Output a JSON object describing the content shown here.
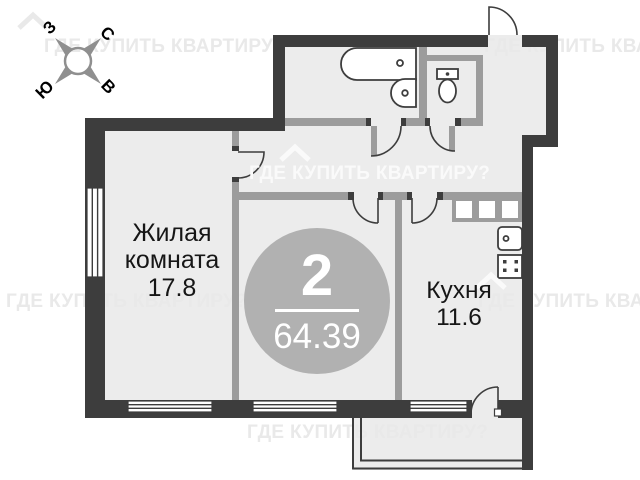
{
  "title": "Floor plan — 2-room apartment",
  "watermark": {
    "text": "ГДЕ КУПИТЬ КВАРТИРУ?"
  },
  "compass": {
    "north": "С",
    "south": "Ю",
    "west": "З",
    "east": "В"
  },
  "badge": {
    "rooms": "2",
    "total_area": "64.39"
  },
  "rooms": {
    "living": {
      "name": "Жилая комната",
      "area": "17.8"
    },
    "kitchen": {
      "name": "Кухня",
      "area": "11.6"
    }
  },
  "icons": [
    "compass-rose-icon",
    "house-roof-icon",
    "bathtub-icon",
    "sink-icon",
    "toilet-icon",
    "kitchen-counter-icon",
    "kitchen-sink-icon",
    "stove-icon",
    "door-swing-icon",
    "window-icon",
    "balcony-icon"
  ],
  "colors": {
    "wall": "#3d3d3d",
    "inner-wall": "#9c9c9c",
    "floor": "#ececec",
    "badge": "#b1b1b1",
    "ink": "#161616",
    "wm-dark": "#e9e9e9",
    "wm-light": "#fafafa",
    "compass": "#8f8f8f"
  }
}
